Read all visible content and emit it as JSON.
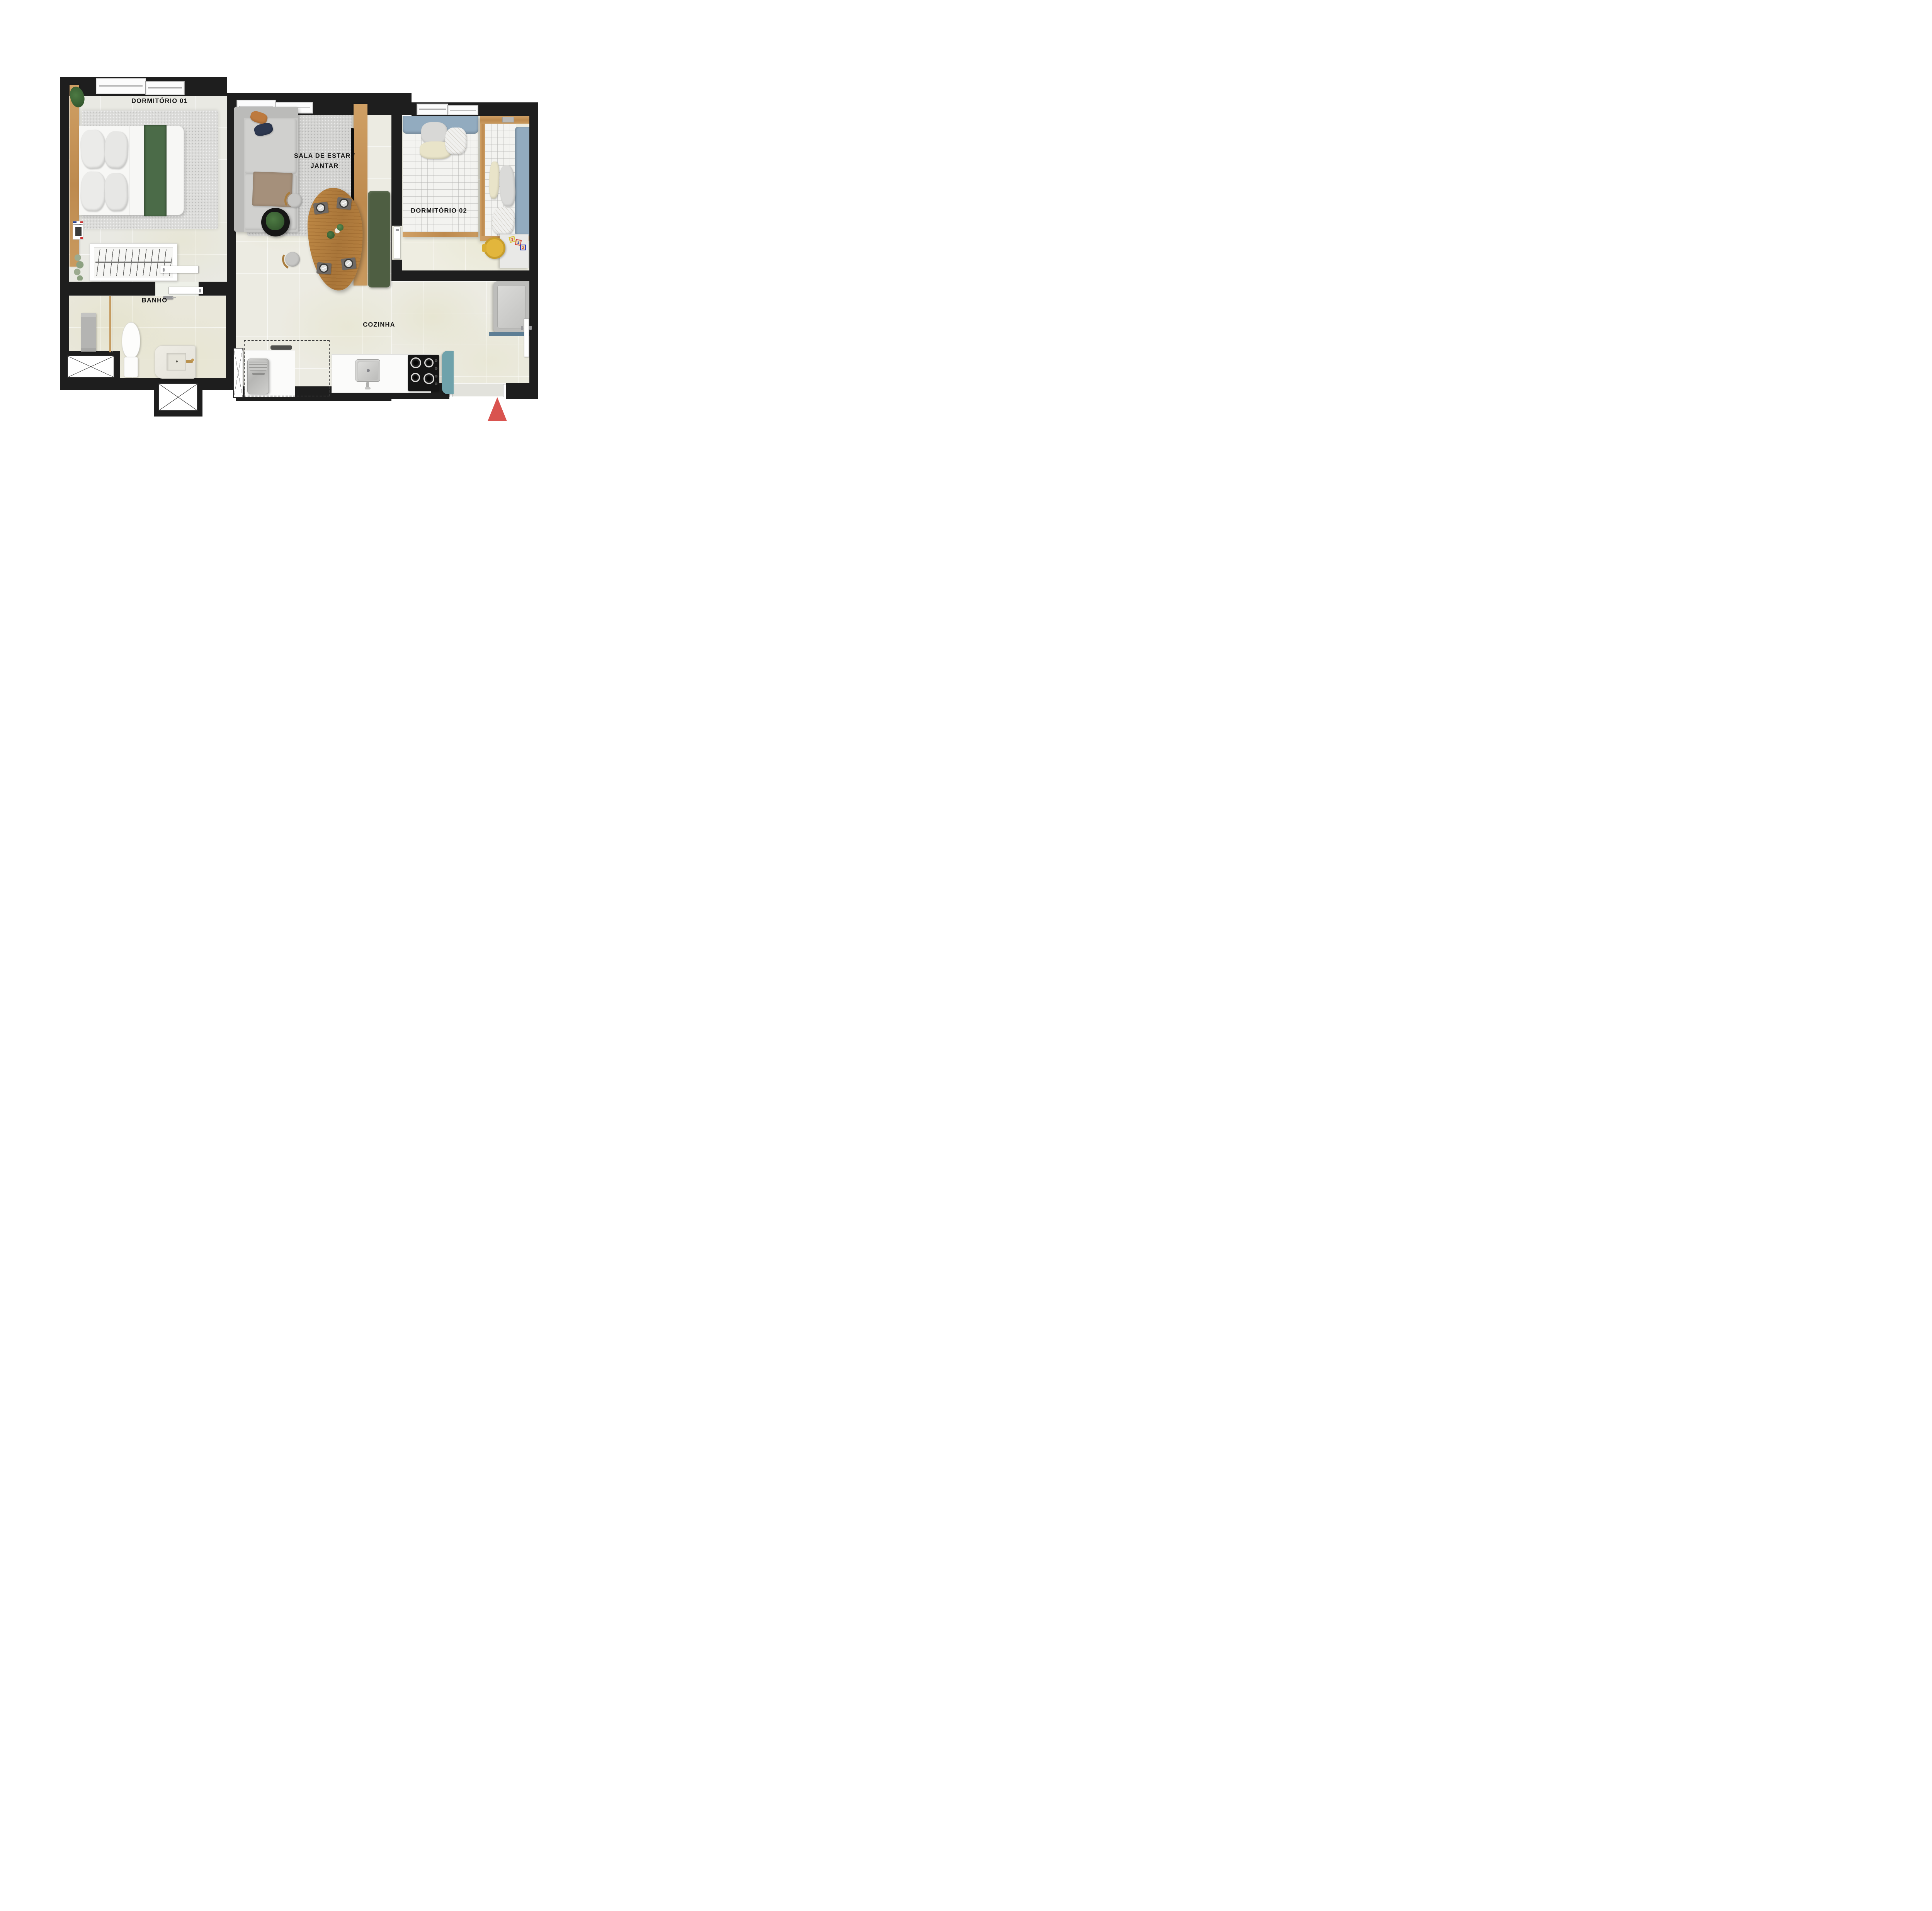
{
  "labels": {
    "bedroom1": "DORMITÓRIO 01",
    "living_line1": "SALA DE ESTAR /",
    "living_line2": "JANTAR",
    "bedroom2": "DORMITÓRIO 02",
    "bathroom": "BANHO",
    "kitchen": "COZINHA"
  },
  "objects": {
    "book_title": "CHIPPERFIELD",
    "toy_blocks": [
      "3",
      "1",
      "2"
    ]
  },
  "icons": {
    "compass": "north-triangle-icon",
    "shafts": "duct-cross-icon",
    "hangers": "clothes-hanger-icon"
  },
  "colors": {
    "walls": "#1e1e1e",
    "floor": "#ecebe2",
    "bedding_green": "#4b6b48",
    "bench_olive": "#4e5e42",
    "wood": "#c4955c",
    "bedding_blue": "#92abbf",
    "teal_appliance": "#6fa2ab",
    "laundry_shelf_blue": "#5d7e95",
    "chair_yellow": "#e2b63c",
    "compass_red": "#d9534f",
    "pillow_orange": "#bd7a3e",
    "pillow_navy": "#2d3850"
  }
}
